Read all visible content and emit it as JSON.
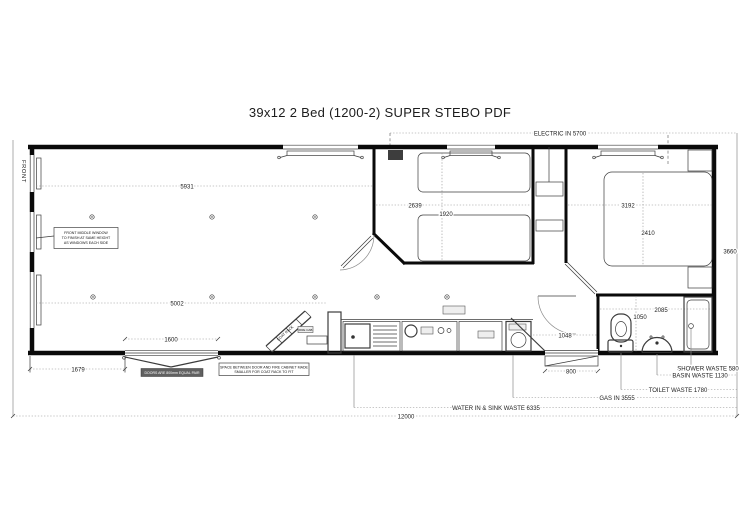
{
  "title": "39x12 2 Bed  (1200-2) SUPER  STEBO PDF",
  "labels": {
    "front": "FRONT",
    "electric_in": "ELECTRIC IN 5700",
    "gas_in": "GAS IN 3555",
    "water_sink_waste": "WATER IN & SINK WASTE 6335",
    "shower_waste": "SHOWER WASTE 580",
    "basin_waste": "BASIN WASTE 1130",
    "toilet_waste": "TOILET WASTE 1780"
  },
  "dimensions": {
    "overall_length": "12000",
    "overall_width": "3660",
    "lounge_top": "5931",
    "lounge_bottom": "5002",
    "bedroom2_width": "2639",
    "bedroom2_bed": "1920",
    "bedroom1_width": "3192",
    "bedroom1_bed": "2410",
    "front_door": "1600",
    "front_door_offset": "1679",
    "hall": "1048",
    "bathroom_top": "2085",
    "bathroom_side": "1050",
    "rear_step": "800"
  },
  "notes": {
    "front_window_l1": "FRONT MIDDLE WINDOW",
    "front_window_l2": "TO FINISH AT SAME HEIGHT",
    "front_window_l3": "AS WINDOWS EACH SIDE",
    "front_door_note": "DOORS ARE 800mm EQUAL PAIR",
    "coat_space_l1": "SPACE BETWEEN DOOR AND FIRE CABINET MADE",
    "coat_space_l2": "SMALLER FOR COAT RACK TO FIT",
    "coat_rack": "COAT RACK",
    "fire_cabinet": "FIRE CAB"
  },
  "colors": {
    "wall": "#0a0a0a",
    "dim_line": "#8f8f8f",
    "text": "#1c1c1c"
  }
}
